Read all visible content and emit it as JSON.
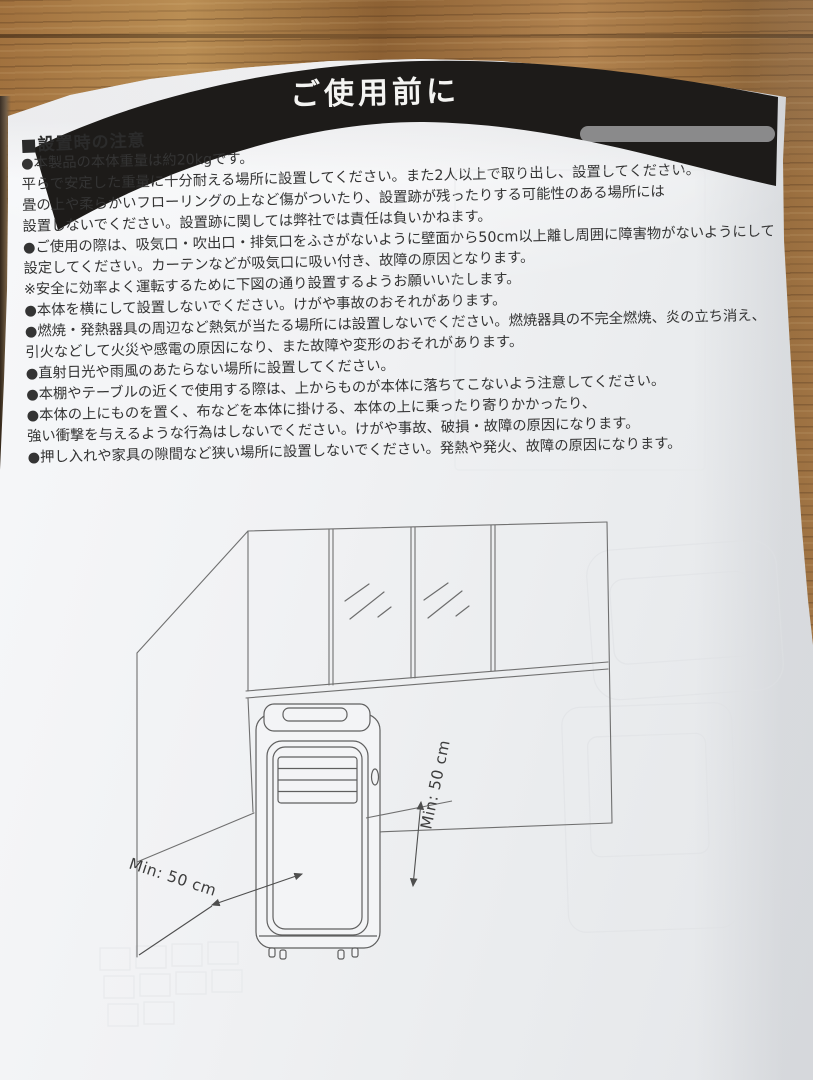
{
  "colors": {
    "band": "#1d1b19",
    "paper": "#f1f2f4",
    "wood": "#a9743a",
    "diagram_line": "#6f6f6f",
    "text": "#343434",
    "title_text": "#f4f4f2"
  },
  "header": {
    "title": "ご使用前に"
  },
  "section": {
    "heading": "■設置時の注意"
  },
  "notes": [
    "●本製品の本体重量は約20kgです。",
    "平らで安定した重量に十分耐える場所に設置してください。また2人以上で取り出し、設置してください。",
    "畳の上や柔らかいフローリングの上など傷がついたり、設置跡が残ったりする可能性のある場所には",
    "設置しないでください。設置跡に関しては弊社では責任は負いかねます。",
    "●ご使用の際は、吸気口・吹出口・排気口をふさがないように壁面から50cm以上離し周囲に障害物がないようにして",
    "設定してください。カーテンなどが吸気口に吸い付き、故障の原因となります。",
    "※安全に効率よく運転するために下図の通り設置するようお願いいたします。",
    "●本体を横にして設置しないでください。けがや事故のおそれがあります。",
    "●燃焼・発熱器具の周辺など熱気が当たる場所には設置しないでください。燃焼器具の不完全燃焼、炎の立ち消え、",
    "引火などして火災や感電の原因になり、また故障や変形のおそれがあります。",
    "●直射日光や雨風のあたらない場所に設置してください。",
    "●本棚やテーブルの近くで使用する際は、上からものが本体に落ちてこないよう注意してください。",
    "●本体の上にものを置く、布などを本体に掛ける、本体の上に乗ったり寄りかかったり、",
    "強い衝撃を与えるような行為はしないでください。けがや事故、破損・故障の原因になります。",
    "●押し入れや家具の隙間など狭い場所に設置しないでください。発熱や発火、故障の原因になります。"
  ],
  "diagram": {
    "min_left_label": "Min: 50 cm",
    "min_right_label": "Min: 50 cm"
  }
}
